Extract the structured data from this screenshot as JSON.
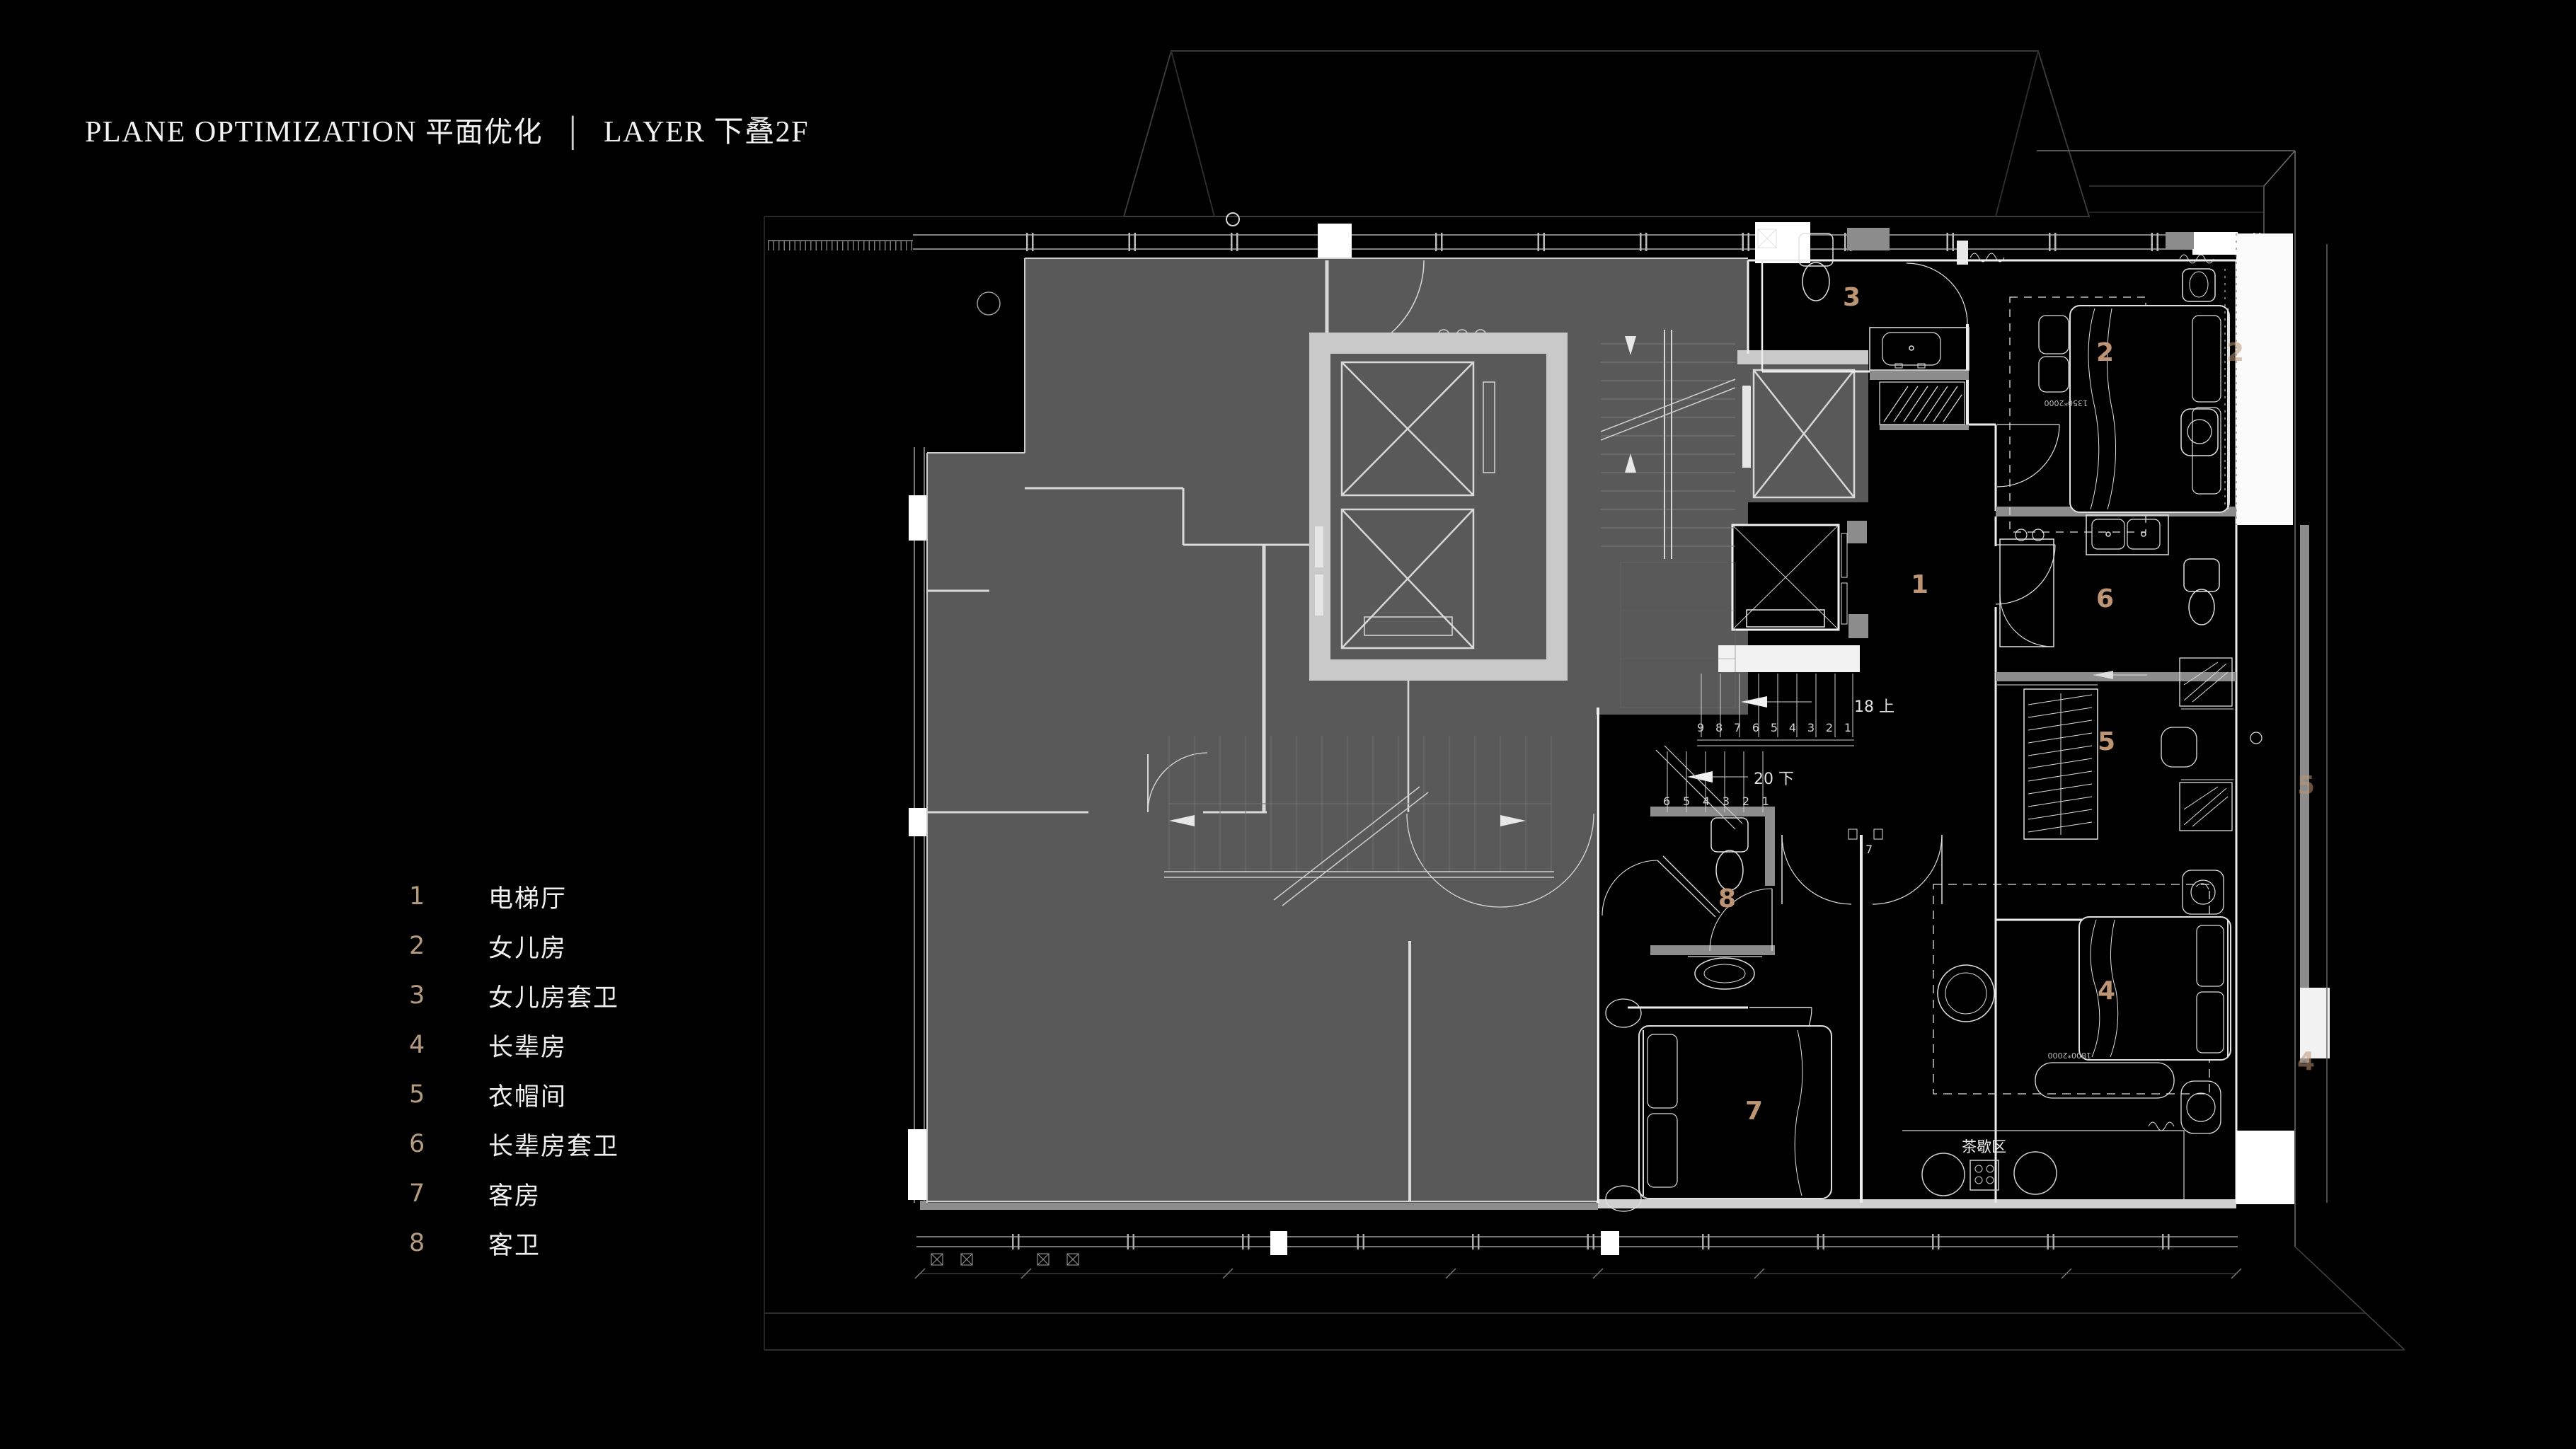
{
  "header": {
    "title_en": "PLANE OPTIMIZATION",
    "title_cn": "平面优化",
    "divider": "│",
    "title_layer": "LAYER 下叠2F"
  },
  "legend": {
    "items": [
      {
        "num": "1",
        "label": "电梯厅"
      },
      {
        "num": "2",
        "label": "女儿房"
      },
      {
        "num": "3",
        "label": "女儿房套卫"
      },
      {
        "num": "4",
        "label": "长辈房"
      },
      {
        "num": "5",
        "label": "衣帽间"
      },
      {
        "num": "6",
        "label": "长辈房套卫"
      },
      {
        "num": "7",
        "label": "客房"
      },
      {
        "num": "8",
        "label": "客卫"
      }
    ]
  },
  "plan": {
    "room_labels": [
      {
        "num": "1"
      },
      {
        "num": "2"
      },
      {
        "num": "3"
      },
      {
        "num": "4"
      },
      {
        "num": "5"
      },
      {
        "num": "6"
      },
      {
        "num": "7"
      },
      {
        "num": "8"
      }
    ],
    "edge_labels": [
      {
        "num": "2"
      },
      {
        "num": "5"
      },
      {
        "num": "4"
      }
    ],
    "stair": {
      "up": "18 上",
      "down": "20 下",
      "treads_upper": "9 8 7 6 5 4 3 2 1",
      "treads_lower": "6 5 4 3 2 1",
      "riser_note": "7"
    },
    "annotations": {
      "tea_area": "茶歇区",
      "bed_dim_small": "1350*2000",
      "bed_dim_large": "1800*2000"
    },
    "colors": {
      "accent": "#bd9574",
      "gray_unit": "#595959",
      "light_wall": "#c9c9c9",
      "mid_wall": "#8c8c8c",
      "white_line": "#ededed"
    }
  }
}
